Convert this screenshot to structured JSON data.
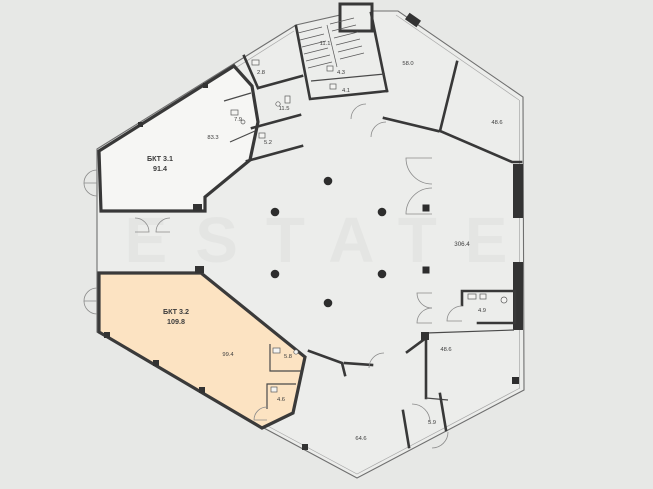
{
  "watermark": "ESTATE",
  "colors": {
    "background": "#e7e8e6",
    "wall": "#383838",
    "highlight_fill": "#fce3c2",
    "unit_fill": "#f6f6f4",
    "label": "#3c3c3c"
  },
  "units": [
    {
      "name": "БКТ 3.1",
      "area": "91.4"
    },
    {
      "name": "БКТ 3.2",
      "area": "109.8"
    }
  ],
  "rooms": {
    "bkt31_main": "83.3",
    "wc_2_8": "2.8",
    "wc_7_9": "7.9",
    "wc_11_5": "11.5",
    "wc_5_2": "5.2",
    "stairwell": "11.1",
    "room_4_3": "4.3",
    "room_4_1": "4.1",
    "room_58_0": "58.0",
    "room_48_6_ne": "48.6",
    "open_space": "306.4",
    "wc_4_9": "4.9",
    "room_48_6_se": "48.6",
    "room_5_9": "5.9",
    "room_64_6": "64.6",
    "bkt32_main": "99.4",
    "room_5_8": "5.8",
    "room_4_6": "4.6"
  }
}
